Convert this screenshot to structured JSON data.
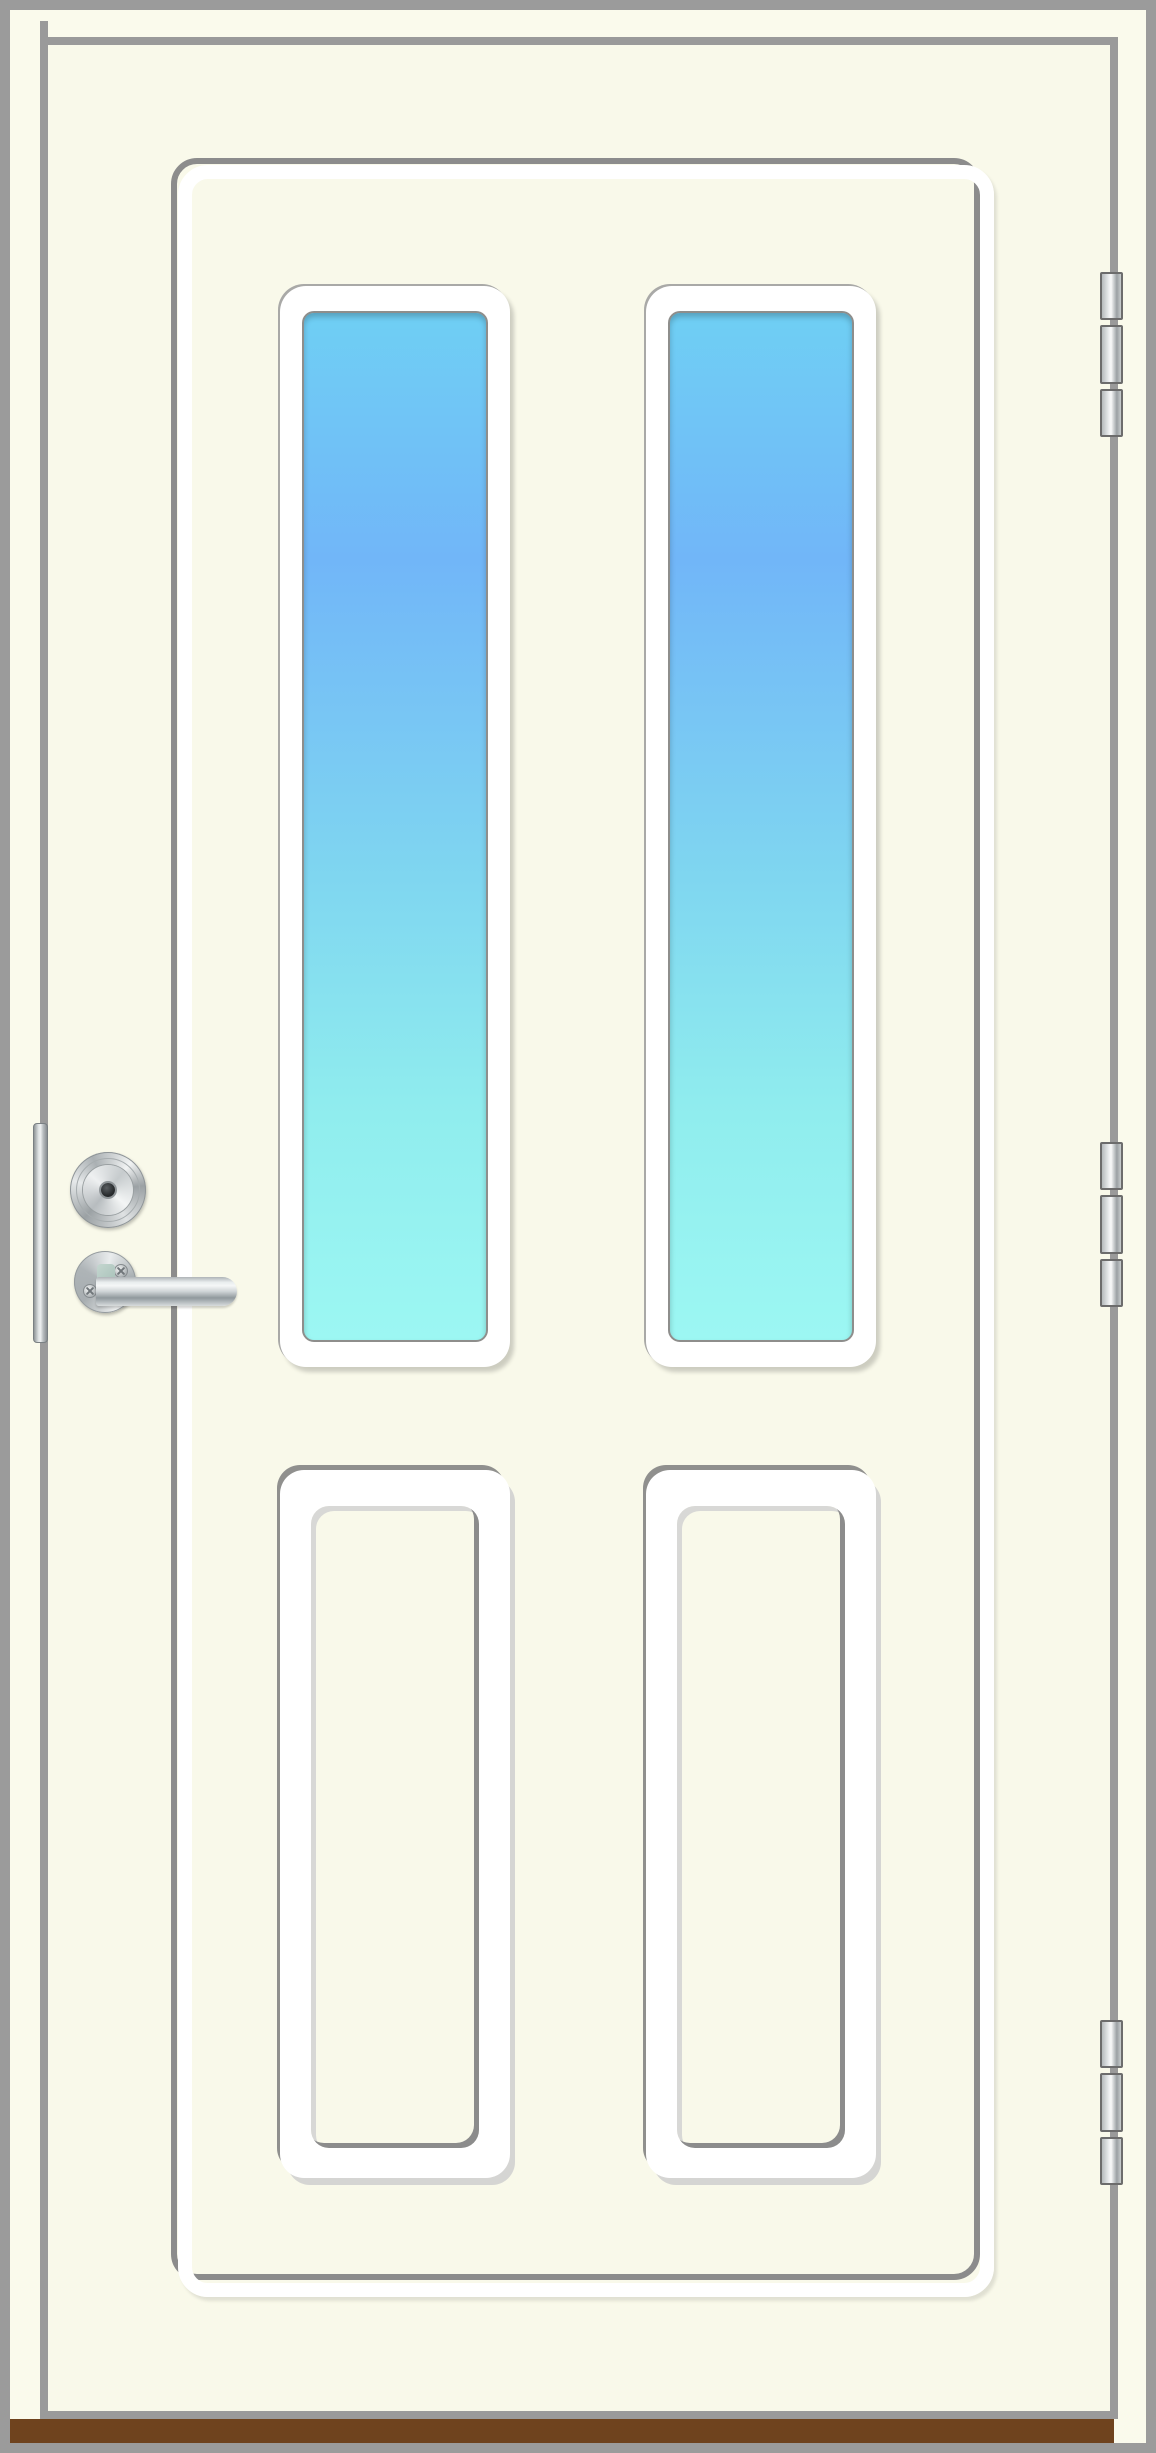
{
  "illustration": {
    "subject": "Closed exterior entrance door, front view",
    "door_style": "white door with two tall vertical glazed panes above two recessed rectangular panels",
    "hardware": {
      "handle": "stainless lever handle on round rosette with two phillips screws",
      "lock": "round stainless lock cylinder with dark keyhole",
      "edge_plate": "vertical stainless strike plate on lock-side door edge",
      "hinges": "three barrel hinges on right side, three knuckles each"
    },
    "counts": {
      "windows": 2,
      "panels": 2,
      "hinges": 3,
      "knuckles_per_hinge": 3
    },
    "threshold": "brown wooden sill strip at door bottom"
  },
  "colors": {
    "frame_gray": "#9b9b9b",
    "gap_gray": "#9a9a9a",
    "frame_ivory": "#fafaec",
    "door_ivory": "#f9f9ea",
    "groove_shadow": "#8c8c8c",
    "groove_highlight": "#ffffff",
    "glass_top": "#6fcff4",
    "glass_mid_blue": "#71b6f8",
    "glass_mid_cyan": "#7fd6f0",
    "glass_aqua": "#90edee",
    "glass_bottom": "#9cf7f3",
    "threshold_brown": "#6f431e",
    "hinge_border": "#6c6c6c",
    "metal_light": "#f1f3f3",
    "metal_mid": "#b5babc",
    "metal_dark": "#8f9598"
  }
}
